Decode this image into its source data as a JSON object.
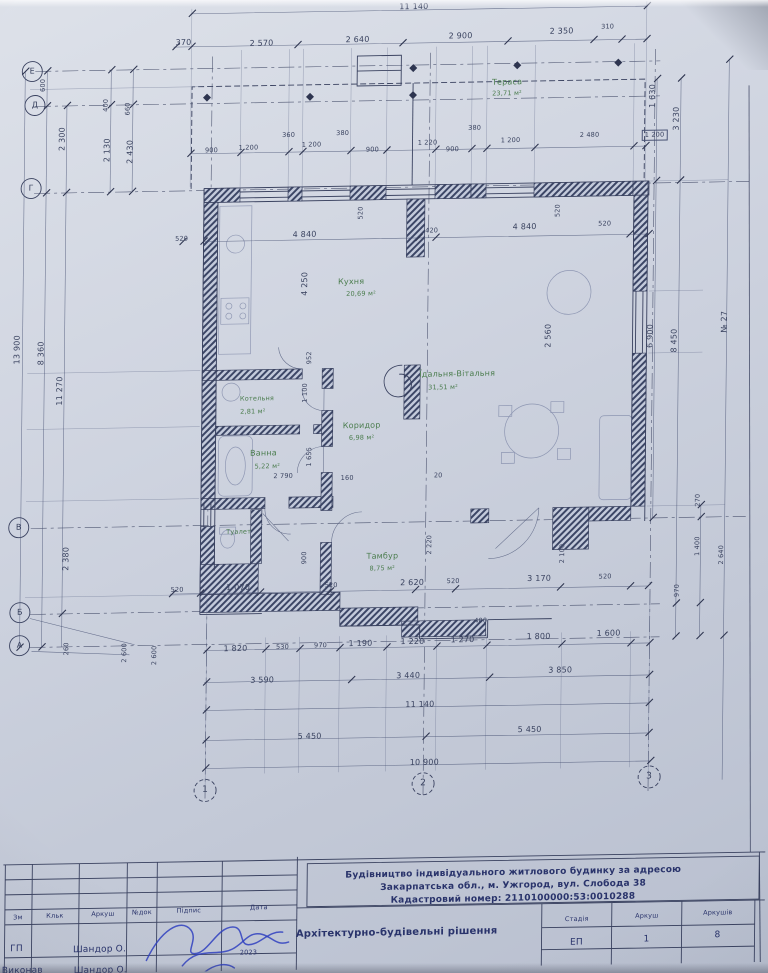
{
  "grid": {
    "rows": [
      "Е",
      "Д",
      "Г",
      "В",
      "Б",
      "А"
    ],
    "cols": [
      "1",
      "2",
      "3"
    ]
  },
  "rooms": [
    {
      "name": "Тераса",
      "area": "23,71 м²"
    },
    {
      "name": "Кухня",
      "area": "20,69 м²"
    },
    {
      "name": "Їдальня-Вітальня",
      "area": "31,51 м²"
    },
    {
      "name": "Коридор",
      "area": "6,98 м²"
    },
    {
      "name": "Котельня",
      "area": "2,81 м²"
    },
    {
      "name": "Ванна",
      "area": "5,22 м²"
    },
    {
      "name": "Туалет",
      "area": ""
    },
    {
      "name": "Тамбур",
      "area": "8,75 м²"
    }
  ],
  "dims": {
    "top_total": "11 140",
    "top_segments": [
      "370",
      "2 570",
      "2 640",
      "2 900",
      "2 350",
      "310"
    ],
    "pier_widths": [
      "360",
      "380",
      "380"
    ],
    "window_row": [
      "900",
      "1 200",
      "1 200",
      "900",
      "1 220",
      "900",
      "1 200",
      "2 480"
    ],
    "right_small_box": "1 200",
    "inner_top": [
      "520",
      "4 840",
      "420",
      "4 840",
      "520"
    ],
    "pier_depths": [
      "520",
      "520"
    ],
    "interior": [
      "4 250",
      "952",
      "1 100",
      "1 655",
      "2 790",
      "160",
      "20",
      "2 560",
      "900",
      "2 220",
      "400"
    ],
    "bottom_wall": [
      "520",
      "1 070",
      "520",
      "2 620",
      "520",
      "3 170",
      "520"
    ],
    "left_col": [
      "600",
      "2 300",
      "400",
      "2 130",
      "660",
      "2 430",
      "13 900",
      "8 360",
      "11 270",
      "2 380",
      "260",
      "2 600",
      "2 600"
    ],
    "right_col": [
      "1 630",
      "3 230",
      "6 900",
      "8 450",
      "№ 27",
      "270",
      "1 400",
      "2 640",
      "970",
      "2 100"
    ],
    "row_segments": [
      "1 820",
      "530",
      "970",
      "1 190",
      "1 220",
      "1 270",
      "1 800",
      "1 600"
    ],
    "row_groups": [
      "3 590",
      "3 440",
      "3 850"
    ],
    "row_total": "11 140",
    "row_halves": [
      "5 450",
      "5 450"
    ],
    "row_overall": "10 900"
  },
  "titleblock": {
    "project_line1": "Будівництво індивідуального житлового будинку за адресою",
    "project_line2": "Закарпатська обл., м. Ужгород, вул. Слобода 38",
    "project_line3": "Кадастровий номер: 2110100000:53:0010288",
    "doc_title": "Архітектурно-будівельні рішення",
    "stage_headers": [
      "Стадія",
      "Аркуш",
      "Аркушів"
    ],
    "stage_values": [
      "ЕП",
      "1",
      "8"
    ],
    "table_headers": [
      "Зм",
      "Кльк",
      "Аркуш",
      "№док",
      "Підпис",
      "Дата"
    ],
    "rows": [
      {
        "role": "ГП",
        "name": "Шандор О.",
        "date": "2023"
      },
      {
        "role": "Виконав",
        "name": "Шандор О.",
        "date": ""
      }
    ]
  }
}
